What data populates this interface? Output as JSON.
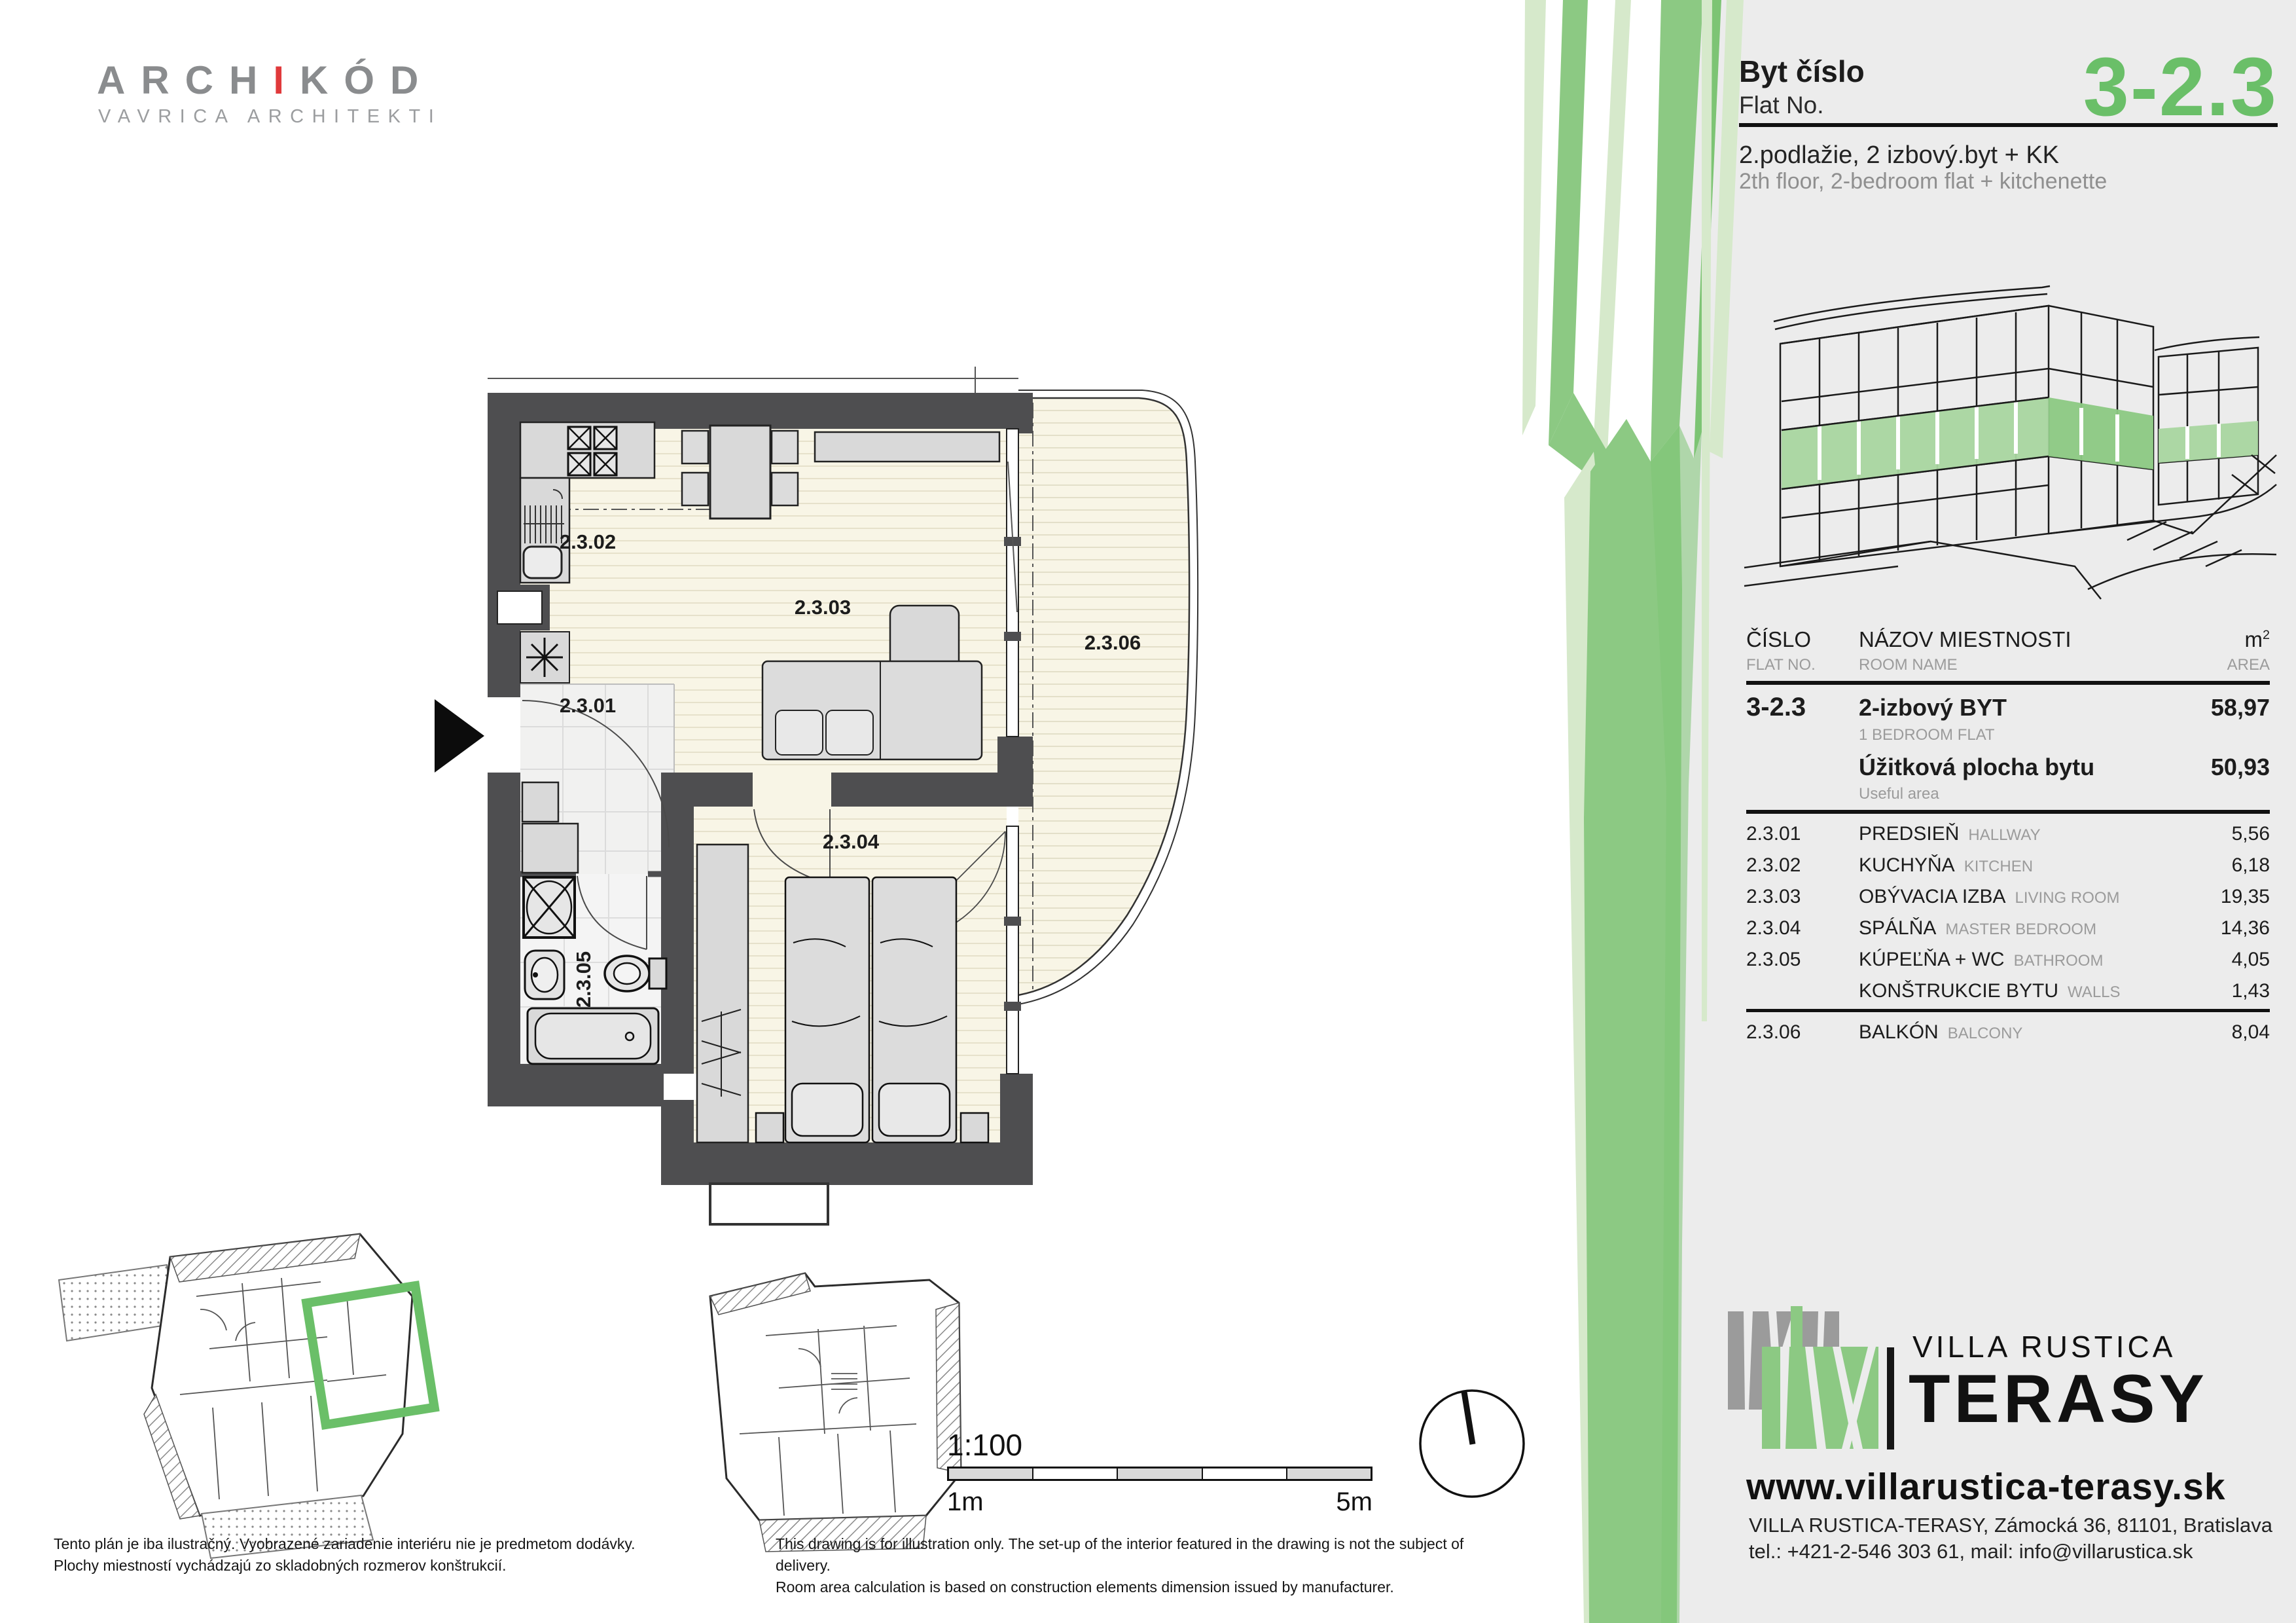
{
  "archikod": {
    "title_pre": "ARCH",
    "title_accent": "I",
    "title_post": "KÓD",
    "subtitle": "VAVRICA ARCHITEKTI"
  },
  "header": {
    "byt_cislo": "Byt číslo",
    "flat_no": "Flat No.",
    "number": "3-2.3",
    "line_sk": "2.podlažie, 2 izbový.byt + KK",
    "line_en": "2th floor, 2-bedroom flat + kitchenette"
  },
  "plan": {
    "rooms": {
      "r01": "2.3.01",
      "r02": "2.3.02",
      "r03": "2.3.03",
      "r04": "2.3.04",
      "r05": "2.3.05",
      "r06": "2.3.06"
    }
  },
  "scale": {
    "ratio": "1:100",
    "min": "1m",
    "max": "5m"
  },
  "table": {
    "header": {
      "cislo": "ČÍSLO",
      "flat_no": "FLAT NO.",
      "nazov": "NÁZOV MIESTNOSTI",
      "room_name": "ROOM NAME",
      "m2": "m",
      "m2_sup": "2",
      "area": "AREA"
    },
    "flat": {
      "code": "3-2.3",
      "name": "2-izbový BYT",
      "name_en": "1 BEDROOM FLAT",
      "area": "58,97",
      "useful_label": "Úžitková plocha bytu",
      "useful_label_en": "Useful area",
      "useful_area": "50,93"
    },
    "rows": [
      {
        "code": "2.3.01",
        "sk": "PREDSIEŇ",
        "en": "HALLWAY",
        "area": "5,56"
      },
      {
        "code": "2.3.02",
        "sk": "KUCHYŇA",
        "en": "KITCHEN",
        "area": "6,18"
      },
      {
        "code": "2.3.03",
        "sk": "OBÝVACIA IZBA",
        "en": "LIVING ROOM",
        "area": "19,35"
      },
      {
        "code": "2.3.04",
        "sk": "SPÁLŇA",
        "en": "MASTER BEDROOM",
        "area": "14,36"
      },
      {
        "code": "2.3.05",
        "sk": "KÚPEĽŇA + WC",
        "en": "BATHROOM",
        "area": "4,05"
      },
      {
        "code": "",
        "sk": "KONŠTRUKCIE BYTU",
        "en": "WALLS",
        "area": "1,43"
      }
    ],
    "balcony": {
      "code": "2.3.06",
      "sk": "BALKÓN",
      "en": "BALCONY",
      "area": "8,04"
    }
  },
  "brand": {
    "line1": "VILLA RUSTICA",
    "line2": "TERASY",
    "website": "www.villarustica-terasy.sk",
    "address": "VILLA RUSTICA-TERASY, Zámocká 36, 81101, Bratislava",
    "contact": "tel.: +421-2-546 303 61, mail: info@villarustica.sk"
  },
  "disclaimer": {
    "sk1": "Tento plán je iba ilustračný. Vyobrazené zariadenie interiéru nie je predmetom dodávky.",
    "sk2": "Plochy miestností vychádzajú zo skladobných rozmerov konštrukcií.",
    "en1": "This drawing is for illustration only. The set-up of the interior featured in the drawing is not the subject of delivery.",
    "en2": "Room area calculation is based on construction elements dimension issued by manufacturer."
  },
  "colors": {
    "accent_green": "#6abf68",
    "strip_mid": "#8cc983",
    "strip_light": "#d6e9cb",
    "panel_gray": "#ececec",
    "wall_gray": "#4e4e50",
    "floor_cream": "#f8f5e6",
    "logo_red": "#e0393b"
  }
}
